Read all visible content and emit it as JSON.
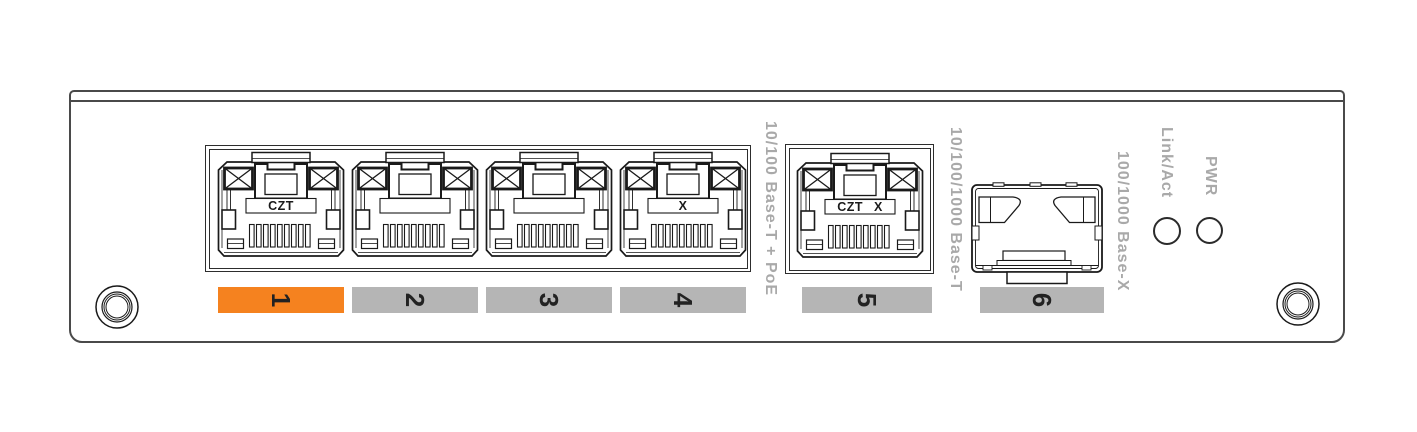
{
  "figure": {
    "ports": [
      {
        "number": "1",
        "jack_label": "CZT",
        "highlighted": true
      },
      {
        "number": "2",
        "jack_label": "",
        "highlighted": false
      },
      {
        "number": "3",
        "jack_label": "",
        "highlighted": false
      },
      {
        "number": "4",
        "jack_label": "X",
        "highlighted": false
      },
      {
        "number": "5",
        "jack_label": "CZT X",
        "highlighted": false
      },
      {
        "number": "6",
        "jack_label": "",
        "highlighted": false
      }
    ],
    "port_type_labels": {
      "ports_1_4": "10/100 Base-T + PoE",
      "port_5": "10/100/1000 Base-T",
      "port_6": "100/1000 Base-X"
    },
    "leds": [
      {
        "label": "Link/Act"
      },
      {
        "label": "PWR"
      }
    ],
    "colors": {
      "highlight_orange": "#F5821F",
      "bar_gray": "#B5B5B5",
      "label_gray": "#A9A9A9",
      "digit_black": "#222222",
      "line_black": "#1A1A1A"
    }
  }
}
